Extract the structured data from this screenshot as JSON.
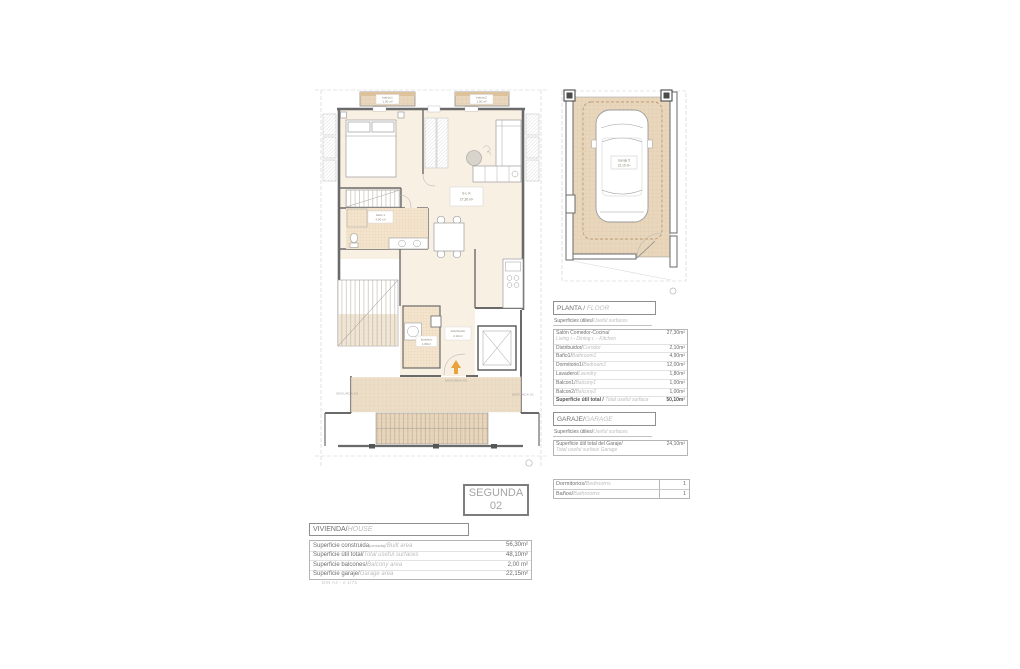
{
  "colors": {
    "accent_arrow": "#e8a33d",
    "tile_tan": "#e9d7bd",
    "tile_bath": "#f4e4ce",
    "room_cream": "#f9f0e4",
    "wall_gray": "#6a6a6a"
  },
  "floor_plan": {
    "balcony1_name": "balcón1",
    "balcony1_area": "1,00 m²",
    "balcony2_name": "balcón2",
    "balcony2_area": "1,00 m²",
    "living_name": "S-L-K",
    "living_area": "27,30 m²",
    "bath_name": "baño 1",
    "bath_area": "4,90 m²",
    "laundry_name": "lavadero",
    "laundry_area": "1,80m²",
    "corridor_name": "distribuidor",
    "corridor_area": "2,10m²",
    "unit_marker": "SEGUNDA 02",
    "neighbor_left": "SEGUNDA 03",
    "neighbor_right": "SEGUNDA 01"
  },
  "garage_plan": {
    "label_name": "Garaje 5",
    "label_area": "22,15 m²"
  },
  "floor_table": {
    "title": "PLANTA / ",
    "title_en": "FLOOR",
    "subtitle": "Superficies útiles/",
    "subtitle_en": "Useful surfaces",
    "rows": [
      {
        "es": "Salón Comedor-Cocina/",
        "en": "Living r.- Dining r. - Kitchen",
        "value": "27,30m²"
      },
      {
        "es": "Distribuidor/",
        "en": "Corridor",
        "value": "2,10m²"
      },
      {
        "es": "Baño1/",
        "en": "Bathroom1",
        "value": "4,90m²"
      },
      {
        "es": "Dormitorio1/",
        "en": "Bedroom1",
        "value": "12,00m²"
      },
      {
        "es": "Lavadero/",
        "en": "Laundry",
        "value": "1,80m²"
      },
      {
        "es": "Balcon1/",
        "en": "Balcony1",
        "value": "1,00m²"
      },
      {
        "es": "Balcon2/",
        "en": "Balcony2",
        "value": "1,00m²"
      }
    ],
    "total_es": "Superficie útil total / ",
    "total_en": "Total useful surface",
    "total_value": "50,10m²"
  },
  "garage_table": {
    "title": "GARAJE/",
    "title_en": "GARAGE",
    "subtitle": "Superficies útiles/",
    "subtitle_en": "Useful surfaces",
    "row_es": "Superficie útil total del Garaje/",
    "row_en": "Total useful surface Garage",
    "value": "24,10m²"
  },
  "rooms_table": {
    "rows": [
      {
        "es": "Dormitorios/",
        "en": "Bedrooms",
        "value": "1"
      },
      {
        "es": "Baños/",
        "en": "Bathrooms",
        "value": "1"
      }
    ]
  },
  "unit_box": {
    "line1": "SEGUNDA",
    "line2": "02"
  },
  "house_table": {
    "title": "VIVIENDA/",
    "title_en": "HOUSE",
    "rows": [
      {
        "es": "Superficie construida",
        "mid": "(cerrada)",
        "en": "/Built area",
        "value": "56,30m²"
      },
      {
        "es": "Superficie útil total/",
        "en": "Total useful surfaces",
        "value": "48,10m²"
      },
      {
        "es": "Superficie balcones/",
        "en": "Balcony area",
        "value": "2,00 m²"
      },
      {
        "es": "Superficie garaje/",
        "en": "Garage area",
        "value": "22,15m²"
      }
    ],
    "note": "DIN A4 - e 1/75"
  }
}
